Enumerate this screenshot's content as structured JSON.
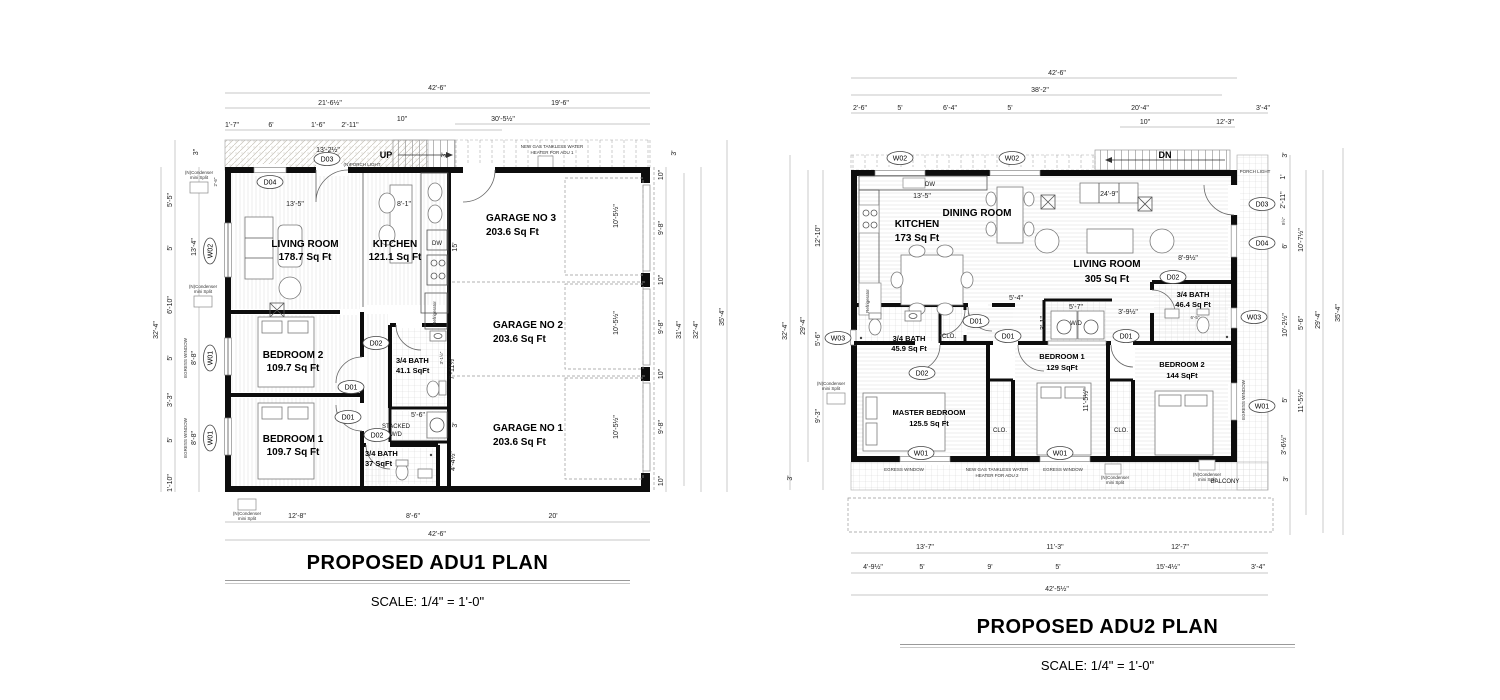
{
  "tags": {
    "d01": "D01",
    "d02": "D02",
    "d03": "D03",
    "d04": "D04",
    "w01": "W01",
    "w02": "W02",
    "w03": "W03"
  },
  "notes": {
    "up": "UP",
    "dn": "DN",
    "dw": "DW",
    "wd": "W/D",
    "stacked1": "STACKED",
    "stacked2": "W/D",
    "fridge": "Refrigerator",
    "porch_light1": "(N)PORCH LIGHT",
    "porch_light2": "PORCH LIGHT",
    "heater1a": "NEW GAS TANKLESS WATER",
    "heater1b": "HEATER FOR ADU 1",
    "heater2a": "NEW GAS TANKLESS WATER",
    "heater2b": "HEATER FOR ADU 2",
    "cond1": "(N)Condenser",
    "cond2": "mini Split",
    "egress": "EGRESS WINDOW",
    "balcony": "BALCONY",
    "clo": "CLO."
  },
  "adu1": {
    "title": "PROPOSED ADU1 PLAN",
    "scale_label": "SCALE: 1/4\" = 1'-0\"",
    "rooms": {
      "living": [
        "LIVING ROOM",
        "178.7 Sq Ft"
      ],
      "kitchen": [
        "KITCHEN",
        "121.1 Sq Ft"
      ],
      "garage3": [
        "GARAGE NO 3",
        "203.6 Sq Ft"
      ],
      "garage2": [
        "GARAGE NO 2",
        "203.6 Sq Ft"
      ],
      "garage1": [
        "GARAGE NO 1",
        "203.6  Sq Ft"
      ],
      "bed2": [
        "BEDROOM 2",
        "109.7 Sq Ft"
      ],
      "bed1": [
        "BEDROOM 1",
        "109.7 Sq Ft"
      ],
      "bath1": [
        "3/4 BATH",
        "41.1 SqFt"
      ],
      "bath2": [
        "3/4 BATH",
        "37 SqFt"
      ]
    },
    "dims_top": [
      "42'-6\"",
      "21'-6½\"",
      "19'-6\"",
      "1'-7\"",
      "6'",
      "1'-6\"",
      "2'-11\"",
      "10\"",
      "30'-5½\"",
      "13'-2½\"",
      "3'",
      "3\"",
      "2'-6\""
    ],
    "dims_left": [
      "32'-4\"",
      "5'-5\"",
      "5'",
      "6'-10\"",
      "5'",
      "3'-3\"",
      "5'",
      "1'-10\"",
      "13'-4\"",
      "8'-8\"",
      "8'-8\""
    ],
    "dims_right": [
      "3'",
      "10\"",
      "9'-8\"",
      "10\"",
      "9'-8\"",
      "10\"",
      "9'-8\"",
      "10\"",
      "31'-4\"",
      "32'-4\"",
      "35'-4\""
    ],
    "dims_bottom": [
      "12'-8\"",
      "8'-6\"",
      "20'",
      "42'-6\""
    ],
    "dims_inner": [
      "13'-5\"",
      "8'-1\"",
      "15'",
      "10'-5½\"",
      "10'-5½\"",
      "10'-5½\"",
      "7'-11½\"",
      "3'",
      "4'-4½\"",
      "5'-6\"",
      "3'-1½\""
    ]
  },
  "adu2": {
    "title": "PROPOSED ADU2 PLAN",
    "scale_label": "SCALE: 1/4\" = 1'-0\"",
    "rooms": {
      "kitchen": [
        "KITCHEN",
        "173 Sq Ft"
      ],
      "dining": [
        "DINING ROOM"
      ],
      "living": [
        "LIVING ROOM",
        "305 Sq Ft"
      ],
      "bath1": [
        "3/4 BATH",
        "45.9 Sq Ft"
      ],
      "bath2": [
        "3/4 BATH",
        "46.4 Sq Ft"
      ],
      "master": [
        "MASTER BEDROOM",
        "125.5 Sq Ft"
      ],
      "bed1": [
        "BEDROOM 1",
        "129 SqFt"
      ],
      "bed2": [
        "BEDROOM 2",
        "144 SqFt"
      ]
    },
    "dims_top": [
      "42'-6\"",
      "38'-2\"",
      "2'-6\"",
      "5'",
      "6'-4\"",
      "5'",
      "20'-4\"",
      "3'-4\"",
      "10\"",
      "12'-3\""
    ],
    "dims_bottom": [
      "13'-7\"",
      "11'-3\"",
      "12'-7\"",
      "4'-9½\"",
      "5'",
      "9'",
      "5'",
      "15'-4½\"",
      "3'-4\"",
      "42'-5½\""
    ],
    "dims_left": [
      "32'-4\"",
      "29'-4\"",
      "12'-10\"",
      "5'-6\"",
      "9'-3\"",
      "3'"
    ],
    "dims_right": [
      "3'",
      "1'",
      "2'-11\"",
      "8½\"",
      "6'",
      "10'-7½\"",
      "10'-2½\"",
      "5'-6\"",
      "5'",
      "3'-6½\"",
      "11'-5½\"",
      "29'-4\"",
      "3'",
      "35'-4\""
    ],
    "dims_inner": [
      "13'-5\"",
      "24'-9\"",
      "5'-4\"",
      "3'-1\"",
      "5'-7\"",
      "3'-9½\"",
      "8'-9½\"",
      "6'-5\"",
      "11'-5½\"",
      "1'-11\""
    ]
  }
}
